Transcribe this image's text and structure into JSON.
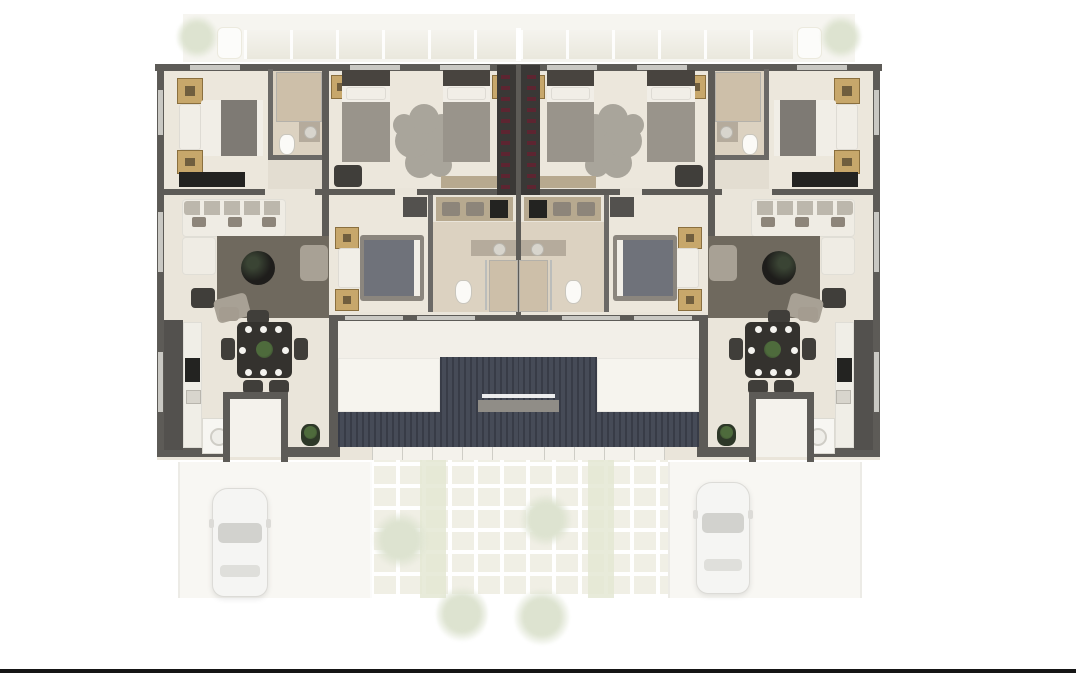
{
  "scene": {
    "title": "Twin duplex residential floor plan - 3D top-down render",
    "view": "top-down",
    "units": 2,
    "symmetry": "mirrored-about-vertical-center",
    "visible_text": "none"
  },
  "canvas": {
    "width": 1076,
    "height": 674
  },
  "colors": {
    "background": "#ffffff",
    "wall": "#5d5b57",
    "wallInner": "#6b6966",
    "window": "#c9c8c3",
    "floor": "#eae5da",
    "floorWarm": "#ece7dc",
    "floorHall": "#e3ddd1",
    "floorPatio": "#f2efe8",
    "bathTile": "#cdbfa9",
    "bathFloor": "#dcd2c1",
    "whiteLedge": "#f6f4ee",
    "sheet": "#f1eee7",
    "blanket": "#7e7a74",
    "blanketBlue": "#6f727a",
    "blanketGray": "#99948b",
    "bedFrame": "#8b867e",
    "headboard": "#48443f",
    "nightstand": "#c7a76b",
    "nightstandDark": "#8a6f3e",
    "closet": "#3a3836",
    "clothes": "#5d2531",
    "rug": "#6f695e",
    "rugFlower": "#a9a59b",
    "sofa": "#efece4",
    "cushion": "#bcb7ac",
    "pillowTaupe": "#8d857a",
    "tableBlack": "#1e1d1b",
    "tableGlint": "#3a4434",
    "diningTable": "#34322e",
    "chair": "#403e3a",
    "chairLight": "#a8a195",
    "stool": "#a49c90",
    "plate": "#f4f3ef",
    "plantGreen": "#4e6b3c",
    "plantDark": "#2e3828",
    "stone": "#464b57",
    "stoneDark": "#383c47",
    "shelf": "#908d87",
    "counter": "#f0eee7",
    "appliance": "#232321",
    "tallUnit": "#53514e",
    "porchFloor": "#f4f2ec",
    "washer": "#f7f6f2",
    "consoleTan": "#b7a98f",
    "vanity": "#b5ab9c",
    "drive": "#f8f7f3",
    "driveEdge": "#ecebe6",
    "paver": "#edecdf",
    "paverGreen": "#e4e8d3",
    "treeFaint": "#dde3d0",
    "carBody": "#f5f5f3",
    "carEdge": "#dcdbd7",
    "carGlass": "#d2d2ce",
    "carGlassLight": "#dfdfdb",
    "yardBand": "#f6f5f0",
    "yardBlock": "#eae8dd",
    "pill": "#fcfcfa",
    "bottomLine": "#161616"
  },
  "plan": {
    "unit_rooms": [
      "master-bedroom",
      "ensuite-bathroom",
      "twin-bedroom",
      "wardrobe-closet",
      "living-room",
      "middle-bedroom",
      "dressing-area",
      "central-bathroom",
      "kitchen",
      "dining-area",
      "laundry-porch",
      "terrace"
    ],
    "shared_features": [
      "stone-accent-wall",
      "stone-planter-band",
      "entry-steps"
    ],
    "furniture_per_unit": {
      "beds": 4,
      "sofas": 1,
      "dining_tables": 1,
      "coffee_tables": 1,
      "wardrobes": 1,
      "washing_machines": 1
    }
  },
  "exterior": {
    "rear_yard": [
      "paved-band",
      "white-bench-left",
      "white-bench-right",
      "faded-shrubs"
    ],
    "front": {
      "driveways": 2,
      "cars": [
        {
          "color": "white",
          "location": "left-driveway"
        },
        {
          "color": "white",
          "location": "right-driveway"
        }
      ],
      "faded": [
        "paving-grid",
        "garden-trees"
      ]
    },
    "border_line_bottom": true
  }
}
